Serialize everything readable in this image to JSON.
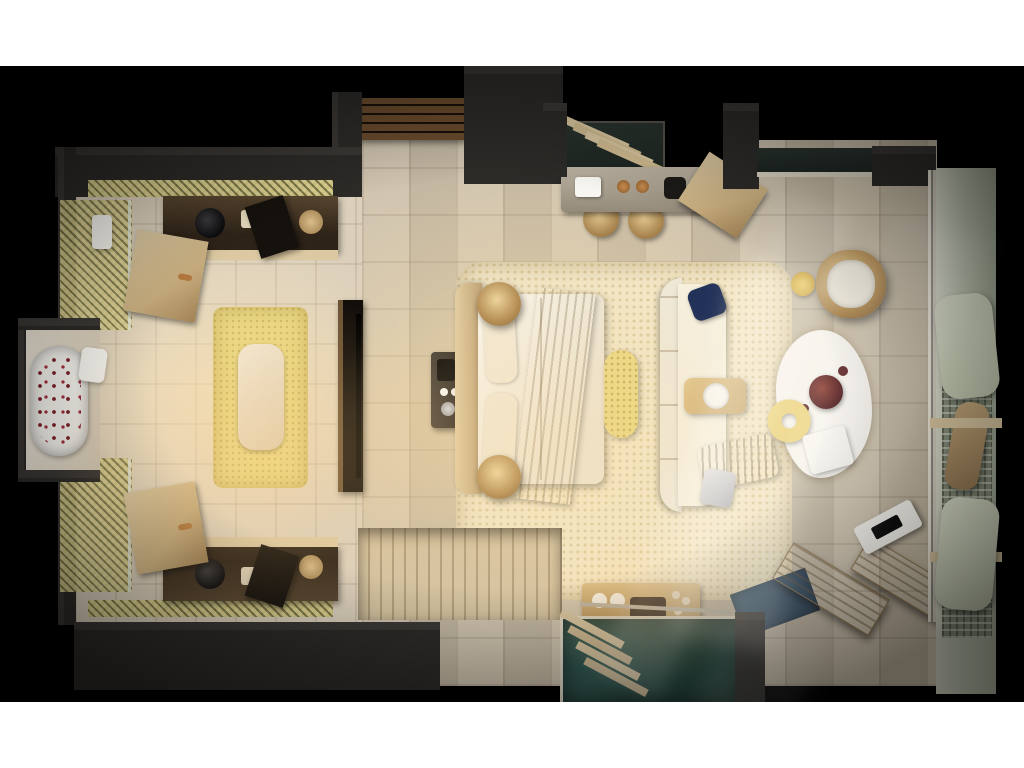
{
  "scene": {
    "type": "3d-floor-plan-render",
    "subject": "top-down 3D render of a luxury hotel suite with bedroom, bathroom, work desk, plunge pool and terrace",
    "visible_text": "none"
  },
  "palette": {
    "page_bg": "#ffffff",
    "matte": "#000000",
    "wall": "#2d2b28",
    "wall_face": "#3b3835",
    "stone": "#cfc2ac",
    "bath_stone": "#dcd0bc",
    "mosaic": "#a79f5e",
    "rug_cream": "#f2e6c5",
    "rug_yellow": "#e9d883",
    "wood": "#c9ae7e",
    "wood_light": "#dcc9a2",
    "wood_dark": "#3f2f1e",
    "deck": "#d5c3a0",
    "linen": "#f5efe2",
    "duvet": "#efe9da",
    "throw": "#c6a97e",
    "navy": "#223158",
    "petal": "#7e1f28",
    "pool": "#39625c",
    "pool_deep": "#27473f",
    "water_blue": "#3b5c74",
    "glassline": "#ddd6c4",
    "outdoor": "#c6cbb6",
    "lattice": "#7e8672",
    "white": "#f8f6f0",
    "gold": "#e3c25c",
    "copper": "#b5793f",
    "silver": "#c9c9cc",
    "tv": "#120e0a"
  },
  "regions": [
    "bathroom",
    "shower",
    "bathtub-alcove",
    "dressing-area",
    "entry-vestibule",
    "work-desk-nook",
    "bedroom",
    "lounge-area",
    "pool-bar",
    "plunge-pool",
    "terrace-deck",
    "outdoor-lounge-gallery"
  ],
  "furniture": [
    "freestanding-bathtub",
    "vanity-console",
    "wardrobe-doors",
    "dressing-bench",
    "tv-partition",
    "minibar-station",
    "double-bed",
    "rattan-pendant-lamps",
    "foot-bench",
    "chaise-sofa",
    "tray-table",
    "hanging-egg-chair",
    "flokati-rug",
    "flower-vase",
    "ring-cushion",
    "writing-desk",
    "rattan-stools",
    "louvered-window",
    "sun-loungers",
    "magazine-stand",
    "pool-steps",
    "daybeds"
  ]
}
